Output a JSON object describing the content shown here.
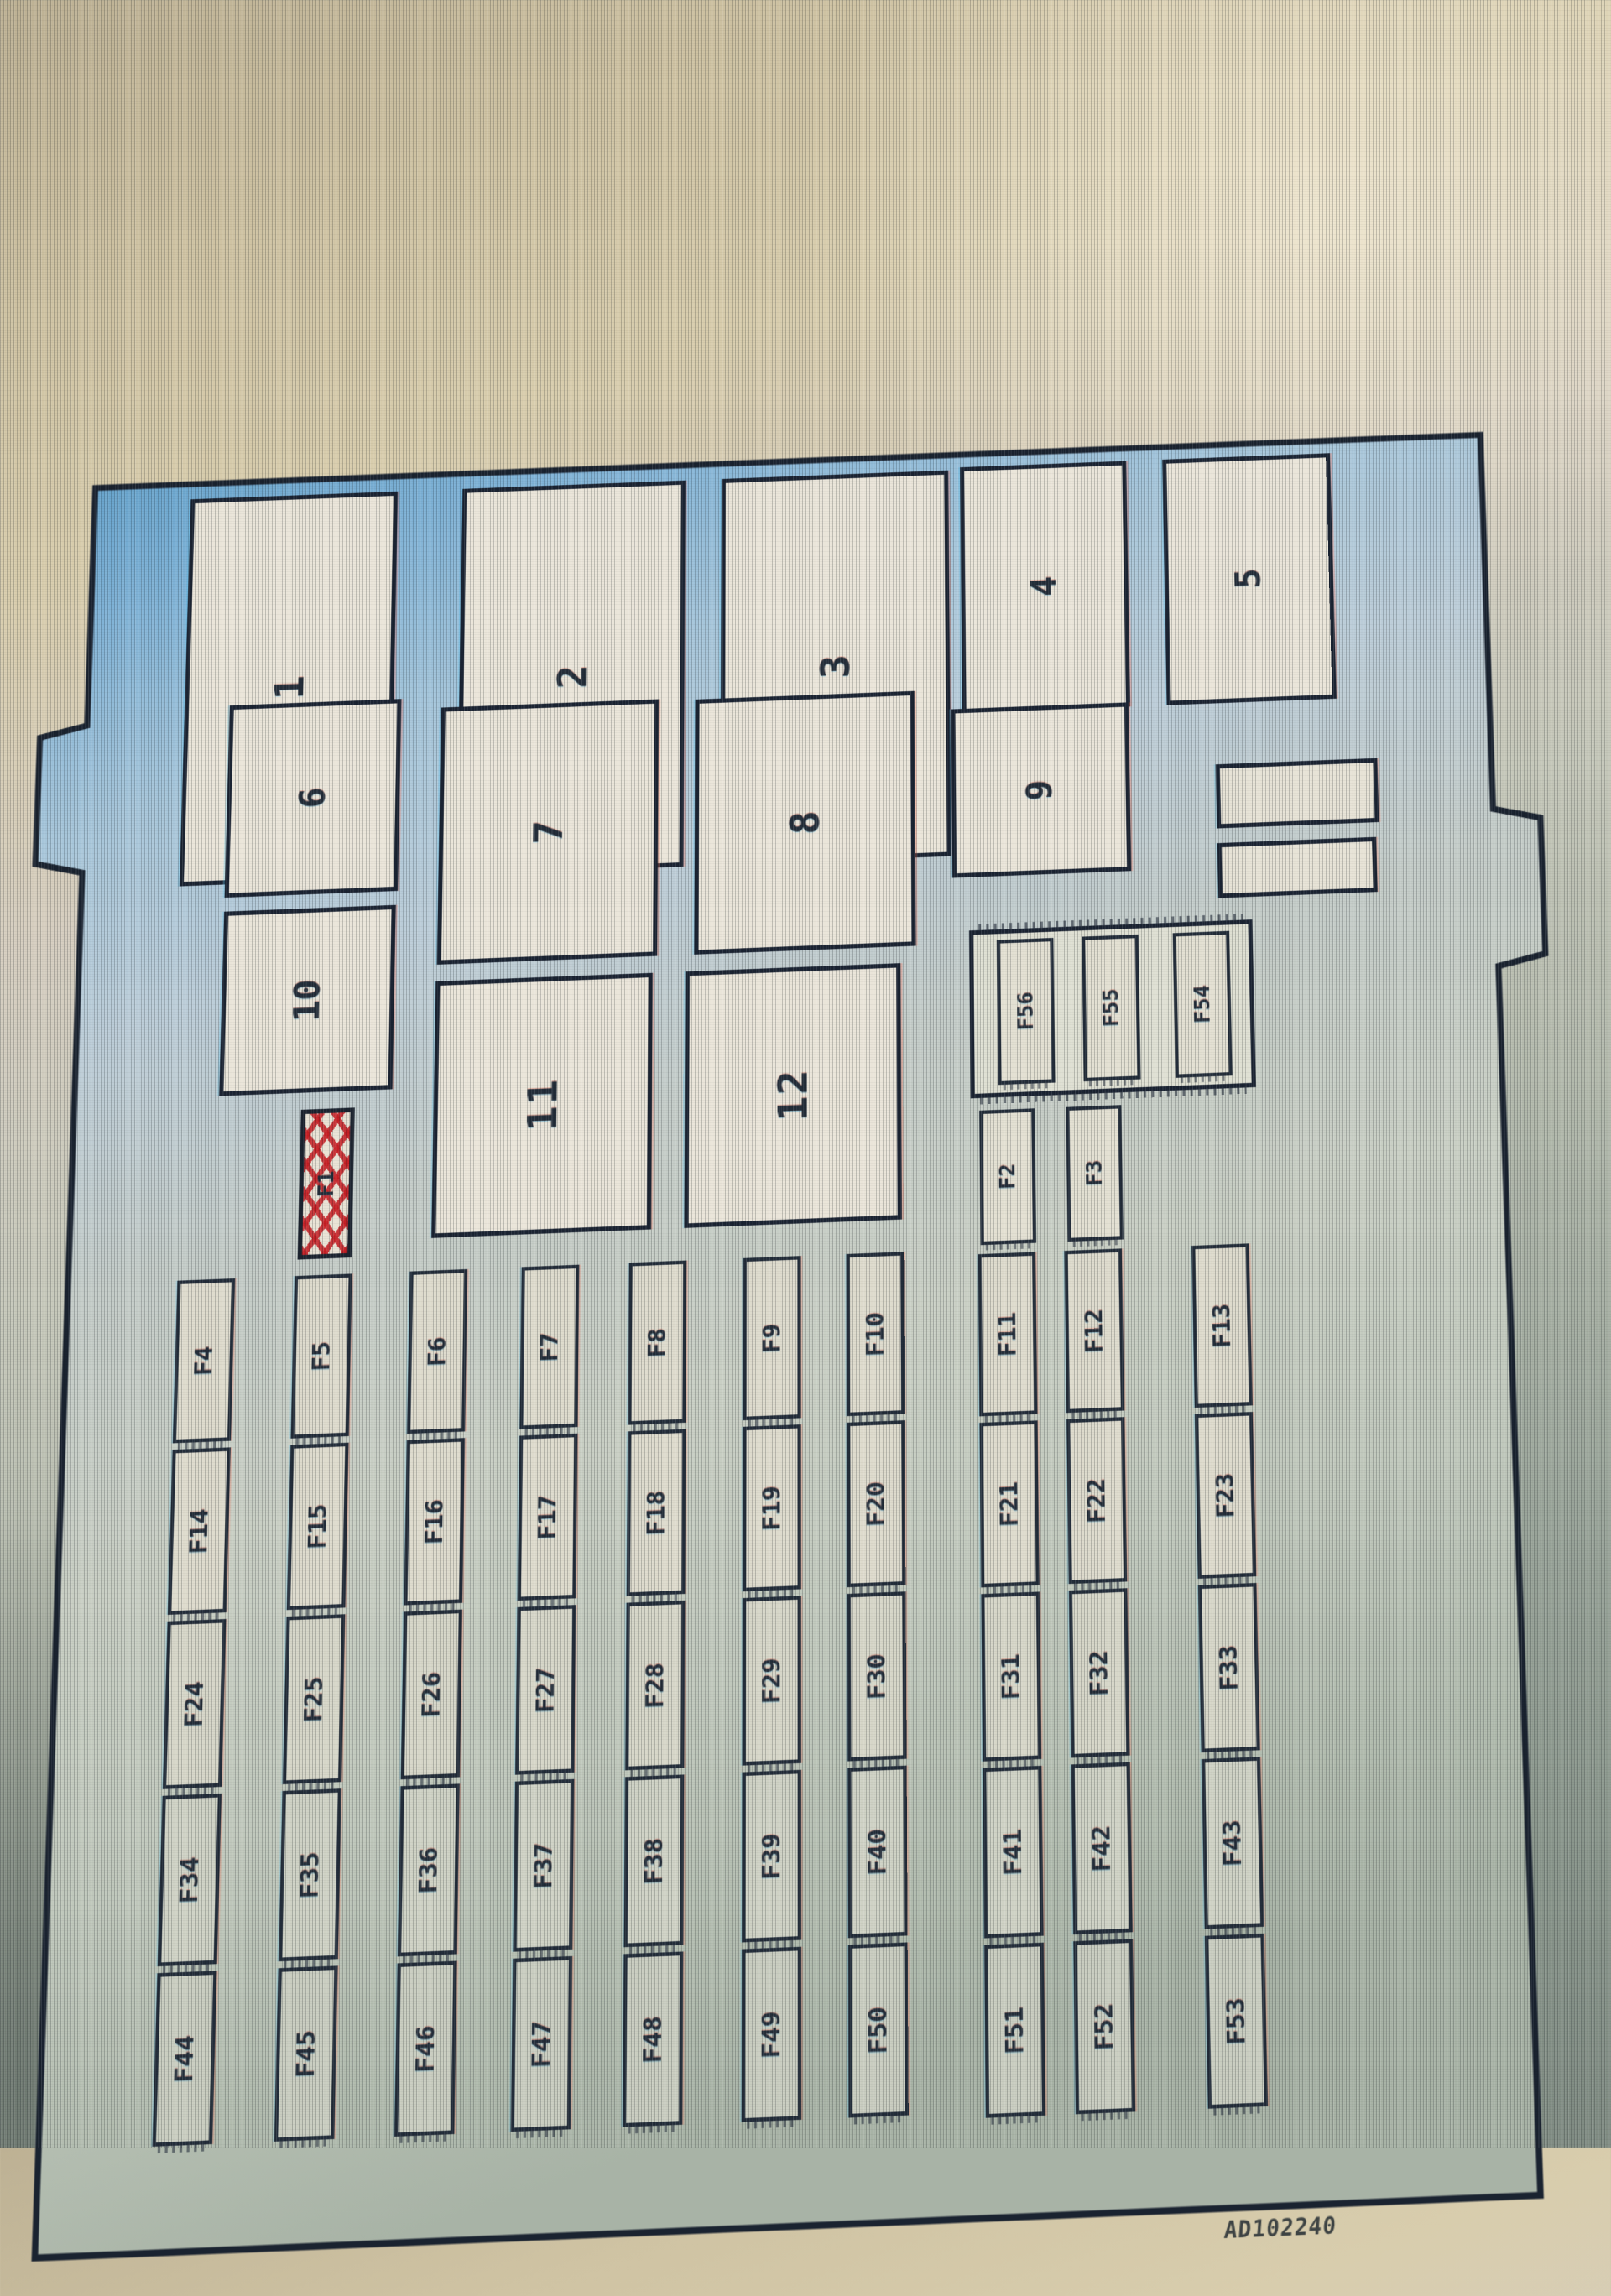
{
  "diagram": {
    "type": "fuse-box-layout",
    "caption": "AD102240",
    "relays": [
      "1",
      "2",
      "3",
      "4",
      "5",
      "6",
      "7",
      "8",
      "9",
      "10",
      "11",
      "12"
    ],
    "spare_bars": {
      "count": 2
    },
    "slot_group": {
      "slots": [
        "F56",
        "F55",
        "F54"
      ]
    },
    "aux_slots": [
      "F2",
      "F3"
    ],
    "marked_fuse": {
      "label": "F1",
      "marked": true,
      "mark_style": "red-crosshatch"
    },
    "fuse_grid": {
      "rows": [
        {
          "cells": [
            "F4",
            "F5",
            "F6",
            "F7",
            "F8",
            "F9",
            "F10",
            "F11",
            "F12",
            "F13"
          ]
        },
        {
          "cells": [
            "F14",
            "F15",
            "F16",
            "F17",
            "F18",
            "F19",
            "F20",
            "F21",
            "F22",
            "F23"
          ]
        },
        {
          "cells": [
            "F24",
            "F25",
            "F26",
            "F27",
            "F28",
            "F29",
            "F30",
            "F31",
            "F32",
            "F33"
          ]
        },
        {
          "cells": [
            "F34",
            "F35",
            "F36",
            "F37",
            "F38",
            "F39",
            "F40",
            "F41",
            "F42",
            "F43"
          ]
        },
        {
          "cells": [
            "F44",
            "F45",
            "F46",
            "F47",
            "F48",
            "F49",
            "F50",
            "F51",
            "F52",
            "F53"
          ]
        }
      ]
    },
    "colors": {
      "plate_blue": "#7fb2d6",
      "background_beige": "#d3c7a6",
      "background_sage": "#93a096",
      "box_fill": "#eae5d9",
      "border": "#1b2433",
      "marked_red": "#c32026"
    }
  }
}
